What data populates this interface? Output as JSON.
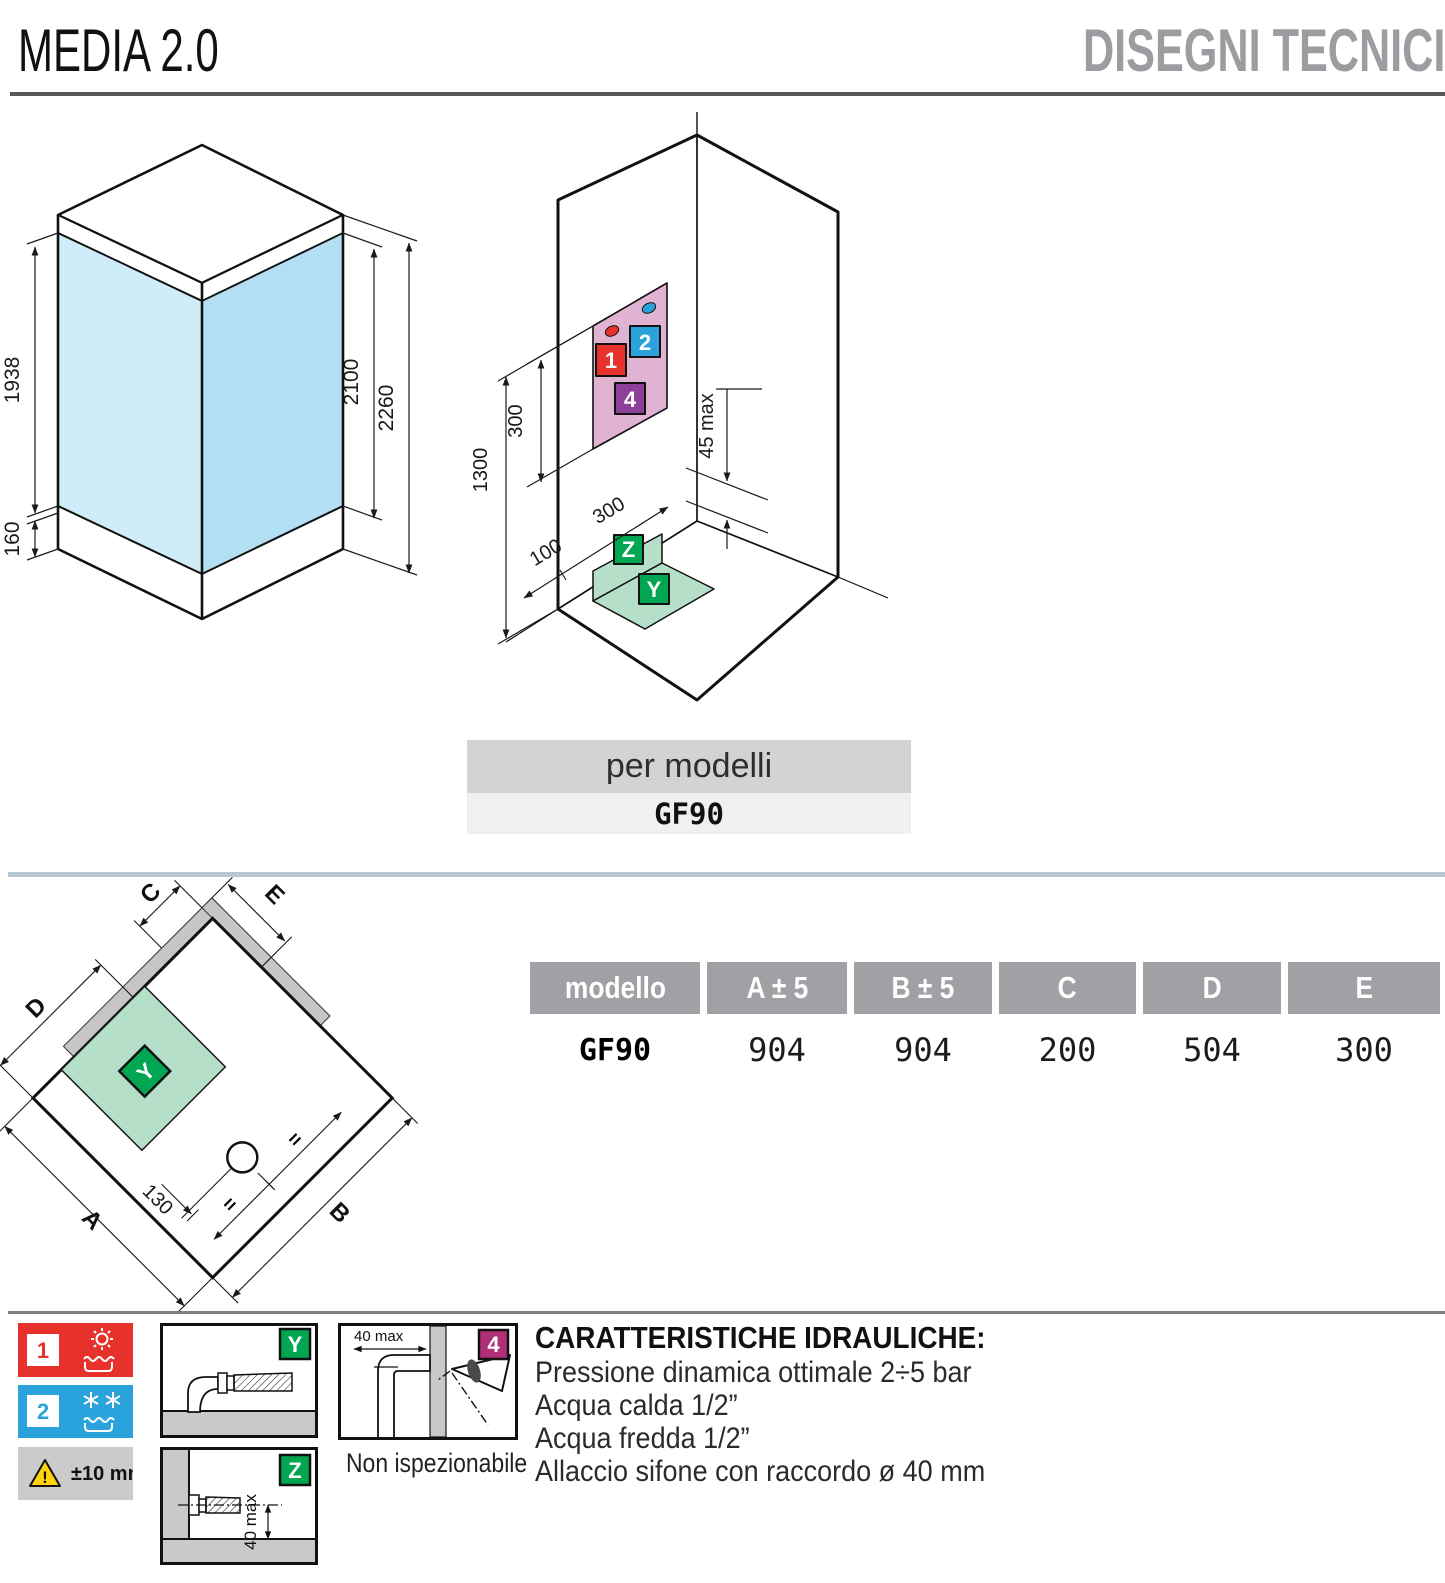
{
  "header": {
    "title": "MEDIA 2.0",
    "section": "DISEGNI TECNICI"
  },
  "per_modelli": {
    "label": "per modelli",
    "value": "GF90"
  },
  "iso_left": {
    "dim_glass": "1938",
    "dim_tray": "160",
    "dim_door": "2100",
    "dim_total": "2260"
  },
  "iso_right": {
    "dim_panel": "300",
    "dim_height": "1300",
    "dim_offset": "100",
    "dim_width": "300",
    "dim_gap": "45 max",
    "marker_hot": "1",
    "marker_cold": "2",
    "marker_four": "4",
    "marker_z": "Z",
    "marker_y": "Y"
  },
  "plan": {
    "label_a": "A",
    "label_b": "B",
    "label_c": "C",
    "label_d": "D",
    "label_e": "E",
    "label_y": "Y",
    "dim_drain": "130",
    "equal_1": "=",
    "equal_2": "="
  },
  "table": {
    "headers": [
      "modello",
      "A ± 5",
      "B ± 5",
      "C",
      "D",
      "E"
    ],
    "rows": [
      [
        "GF90",
        "904",
        "904",
        "200",
        "504",
        "300"
      ]
    ]
  },
  "legend": {
    "hot_number": "1",
    "cold_number": "2",
    "tolerance": "±10 mm",
    "badge_y": "Y",
    "badge_z": "Z",
    "badge_four": "4",
    "dim_z": "40 max",
    "dim_four": "40 max",
    "caption_four": "Non ispezionabile"
  },
  "hydraulics": {
    "title": "CARATTERISTICHE IDRAULICHE:",
    "lines": [
      "Pressione dinamica ottimale 2÷5 bar",
      "Acqua calda 1/2”",
      "Acqua fredda 1/2”",
      "Allaccio sifone con raccordo ø 40 mm"
    ]
  },
  "colors": {
    "hot": "#e6322a",
    "cold": "#2aa3dc",
    "green": "#00a651",
    "green_light": "#b5dfc9",
    "purple": "#8d4097",
    "magenta": "#b03077",
    "pink": "#e0b3d2",
    "glass_left": "#cfecf9",
    "glass_right": "#b3dff4",
    "header_gray": "#9d9da1",
    "table_header": "#a1a1a5",
    "wall_gray": "#c6c6c8",
    "warning": "#ffd40e"
  }
}
